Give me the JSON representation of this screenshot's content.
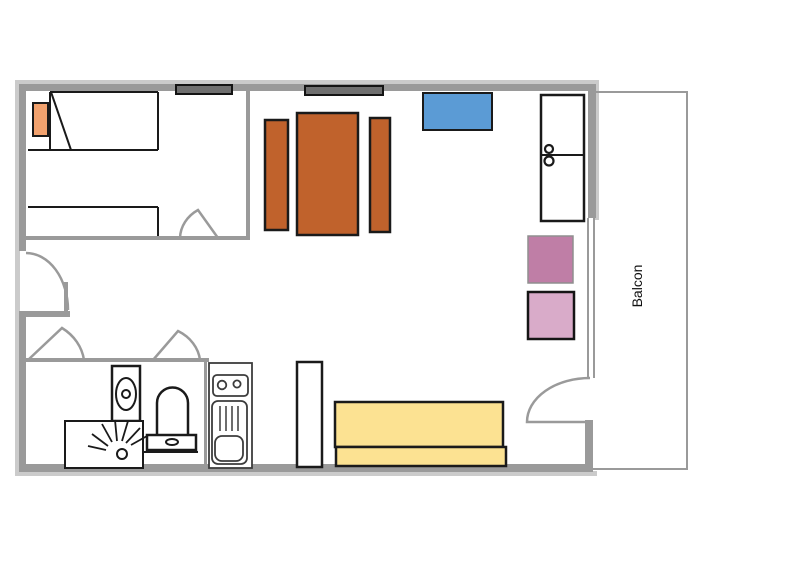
{
  "labels": {
    "balcony": "Balcon"
  },
  "colors": {
    "wall": "#9a9a9a",
    "wall_shadow": "#cbcbcb",
    "outline": "#1a1a1a",
    "window_bar": "#6f6f6f",
    "table_wood": "#c0622c",
    "tv_blue": "#5b9bd5",
    "pillow_orange": "#f2a26e",
    "sofa_yellow": "#fce292",
    "stool_dark_pink": "#bf7ea6",
    "stool_dark_border": "#8f8f8f",
    "stool_light_pink": "#d9abc9",
    "fixture_gray": "#3c3c3c",
    "label_text": "#111111"
  }
}
